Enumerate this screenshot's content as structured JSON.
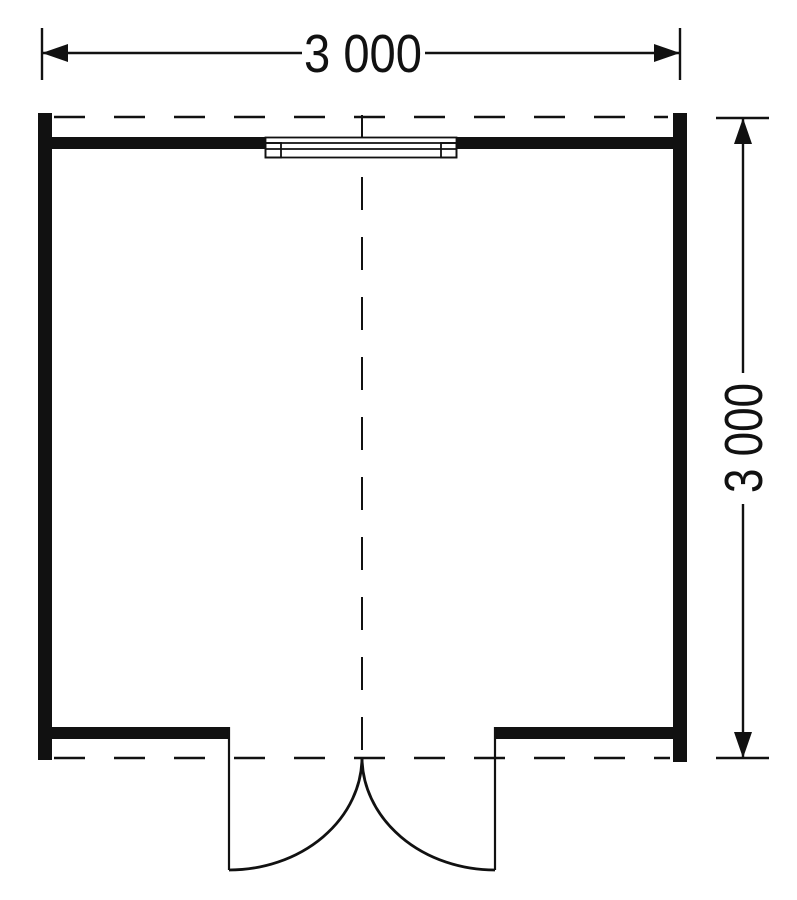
{
  "dimensions": {
    "horizontal": {
      "label": "3 000"
    },
    "vertical": {
      "label": "3 000"
    }
  },
  "colors": {
    "ink": "#111111",
    "paper": "#ffffff"
  }
}
